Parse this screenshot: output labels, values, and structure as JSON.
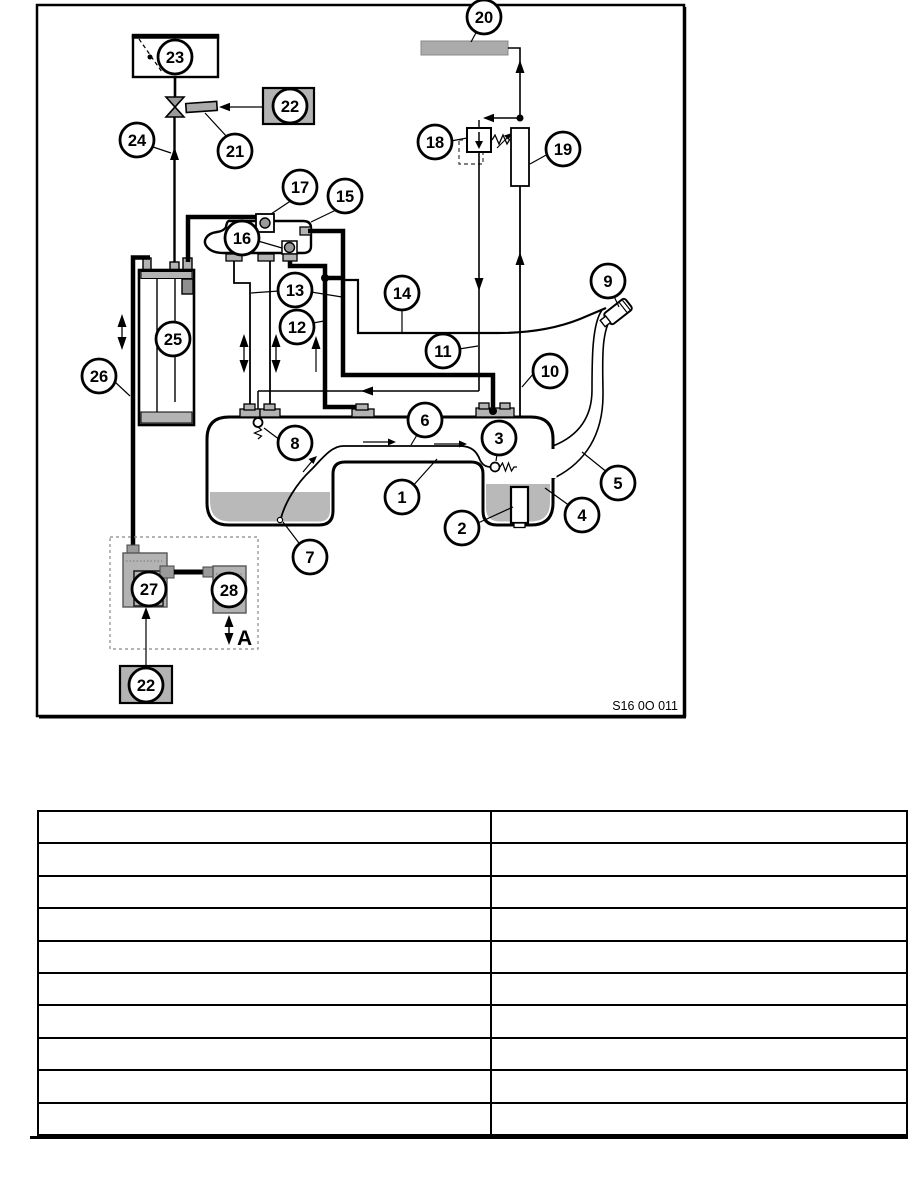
{
  "page": {
    "background": "#ffffff"
  },
  "diagram": {
    "caption": "S16 0O 011",
    "region_label": "A",
    "colors": {
      "line": "#000000",
      "component_gray": "#b3b3b3",
      "fitting_gray": "#a6a6a6",
      "fuel_gray": "#b9b9b9",
      "bar_gray": "#ababab"
    },
    "callouts": [
      {
        "n": "1",
        "x": 402,
        "y": 497,
        "leaders": [
          [
            411,
            488,
            437,
            459
          ]
        ]
      },
      {
        "n": "2",
        "x": 462,
        "y": 528,
        "leaders": [
          [
            478,
            523,
            513,
            507
          ]
        ]
      },
      {
        "n": "3",
        "x": 499,
        "y": 438,
        "leaders": [
          [
            498,
            448,
            496,
            461
          ]
        ]
      },
      {
        "n": "4",
        "x": 582,
        "y": 515,
        "leaders": [
          [
            570,
            506,
            545,
            488
          ]
        ]
      },
      {
        "n": "5",
        "x": 618,
        "y": 483,
        "leaders": [
          [
            608,
            473,
            582,
            452
          ]
        ]
      },
      {
        "n": "6",
        "x": 425,
        "y": 420,
        "leaders": [
          [
            420,
            430,
            411,
            445
          ]
        ]
      },
      {
        "n": "7",
        "x": 310,
        "y": 557,
        "leaders": [
          [
            302,
            547,
            283,
            522
          ]
        ]
      },
      {
        "n": "8",
        "x": 295,
        "y": 443,
        "leaders": [
          [
            280,
            440,
            264,
            428
          ]
        ]
      },
      {
        "n": "9",
        "x": 608,
        "y": 281,
        "leaders": [
          [
            612,
            292,
            619,
            307
          ]
        ]
      },
      {
        "n": "10",
        "x": 550,
        "y": 371,
        "leaders": [
          [
            540,
            366,
            522,
            387
          ]
        ]
      },
      {
        "n": "11",
        "x": 443,
        "y": 351,
        "leaders": [
          [
            459,
            349,
            478,
            346
          ]
        ]
      },
      {
        "n": "12",
        "x": 297,
        "y": 327,
        "leaders": [
          [
            313,
            323,
            324,
            321
          ]
        ]
      },
      {
        "n": "13",
        "x": 295,
        "y": 290,
        "leaders": [
          [
            279,
            291,
            251,
            293
          ],
          [
            311,
            292,
            342,
            297
          ]
        ]
      },
      {
        "n": "14",
        "x": 402,
        "y": 293,
        "leaders": [
          [
            402,
            309,
            402,
            332
          ]
        ]
      },
      {
        "n": "15",
        "x": 345,
        "y": 196,
        "leaders": [
          [
            336,
            210,
            311,
            222
          ]
        ]
      },
      {
        "n": "16",
        "x": 242,
        "y": 238,
        "leaders": [
          [
            258,
            241,
            282,
            248
          ]
        ]
      },
      {
        "n": "17",
        "x": 300,
        "y": 187,
        "leaders": [
          [
            292,
            200,
            271,
            214
          ]
        ]
      },
      {
        "n": "18",
        "x": 435,
        "y": 142,
        "leaders": [
          [
            451,
            141,
            467,
            138
          ]
        ]
      },
      {
        "n": "19",
        "x": 563,
        "y": 149,
        "leaders": [
          [
            548,
            154,
            530,
            164
          ]
        ]
      },
      {
        "n": "20",
        "x": 484,
        "y": 17,
        "leaders": [
          [
            477,
            31,
            471,
            42
          ]
        ]
      },
      {
        "n": "21",
        "x": 235,
        "y": 151,
        "leaders": [
          [
            228,
            138,
            205,
            113
          ]
        ]
      },
      {
        "n": "22",
        "x": 290,
        "y": 106,
        "leaders": []
      },
      {
        "n": "23",
        "x": 175,
        "y": 57,
        "leaders": []
      },
      {
        "n": "24",
        "x": 137,
        "y": 140,
        "leaders": [
          [
            150,
            146,
            171,
            153
          ]
        ]
      },
      {
        "n": "25",
        "x": 173,
        "y": 339,
        "leaders": []
      },
      {
        "n": "26",
        "x": 99,
        "y": 376,
        "leaders": [
          [
            114,
            381,
            130,
            396
          ]
        ]
      },
      {
        "n": "27",
        "x": 149,
        "y": 589,
        "leaders": []
      },
      {
        "n": "28",
        "x": 229,
        "y": 590,
        "leaders": []
      },
      {
        "n": "22",
        "x": 146,
        "y": 685,
        "leaders": []
      }
    ]
  },
  "table": {
    "columns": 2,
    "rows": 10,
    "cells": [
      [
        "",
        ""
      ],
      [
        "",
        ""
      ],
      [
        "",
        ""
      ],
      [
        "",
        ""
      ],
      [
        "",
        ""
      ],
      [
        "",
        ""
      ],
      [
        "",
        ""
      ],
      [
        "",
        ""
      ],
      [
        "",
        ""
      ],
      [
        "",
        ""
      ]
    ]
  }
}
